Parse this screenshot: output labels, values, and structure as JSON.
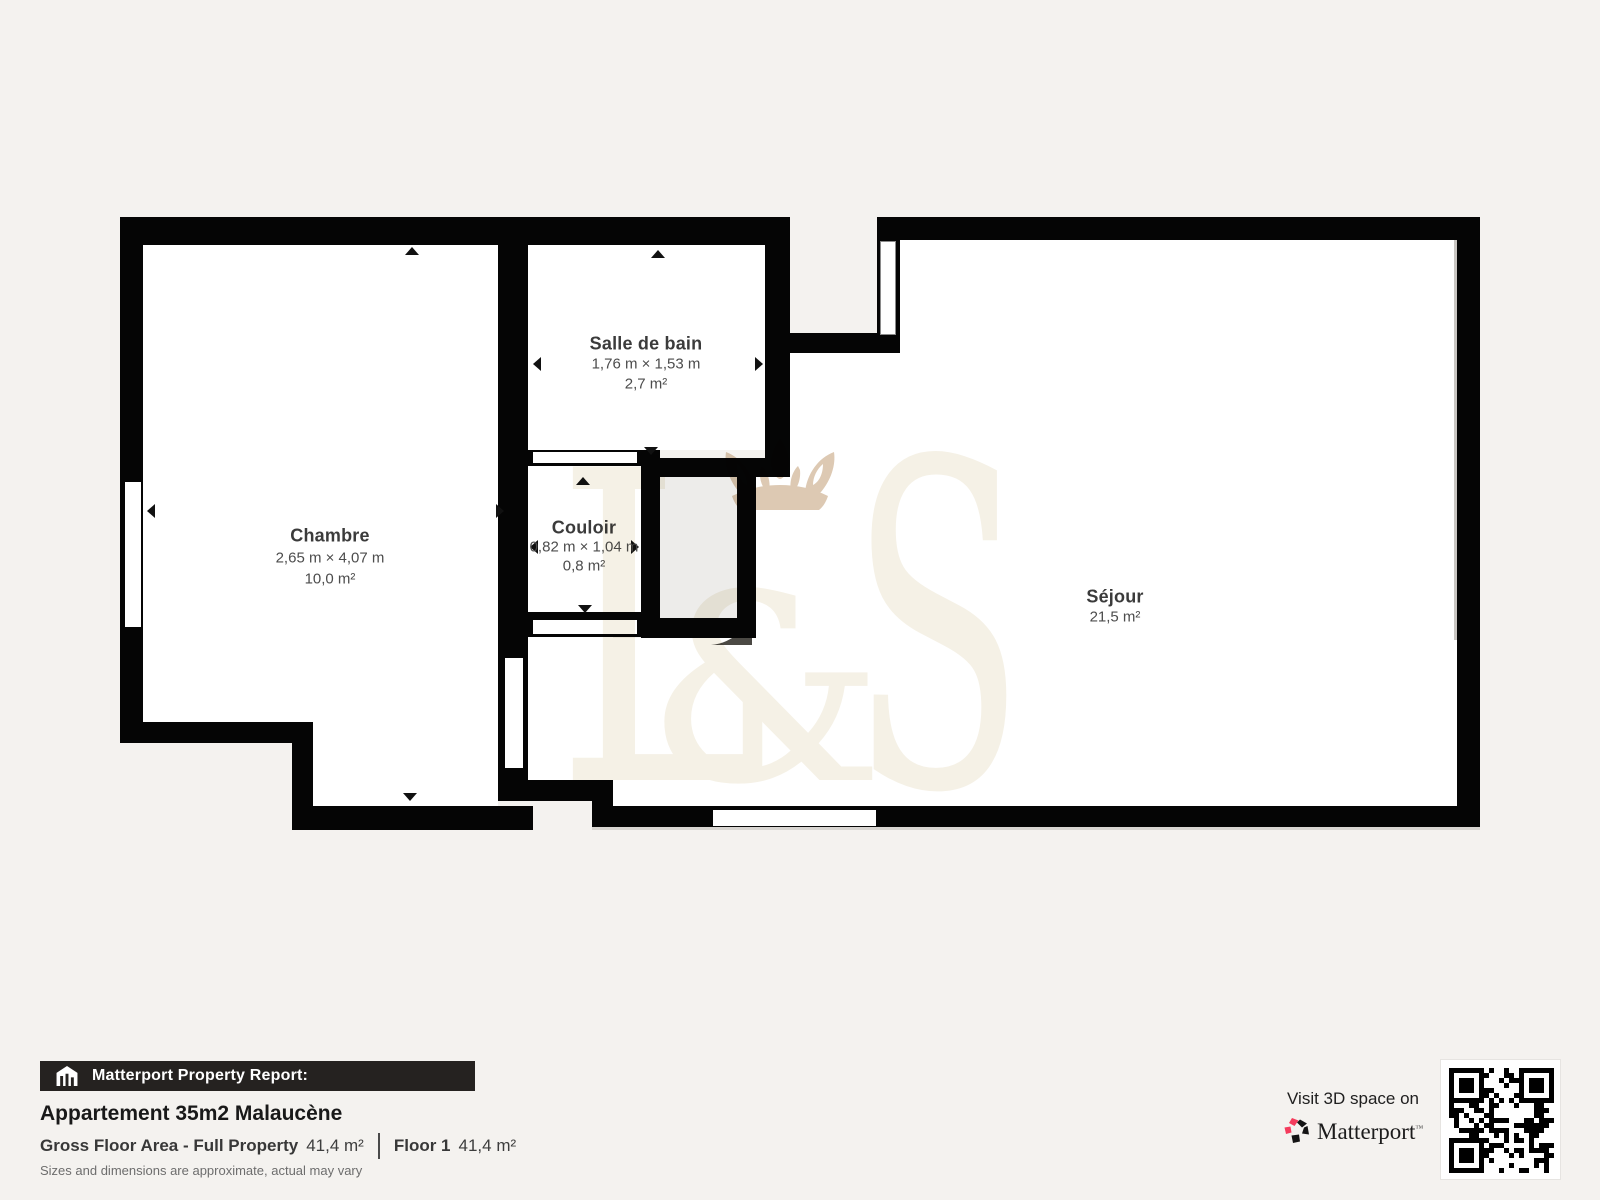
{
  "plan": {
    "rooms": [
      {
        "name": "Chambre",
        "dims": "2,65 m × 4,07 m",
        "area": "10,0 m²"
      },
      {
        "name": "Salle de bain",
        "dims": "1,76 m × 1,53 m",
        "area": "2,7 m²"
      },
      {
        "name": "Couloir",
        "dims": "0,82 m × 1,04 m",
        "area": "0,8 m²"
      },
      {
        "name": "Séjour",
        "area": "21,5 m²"
      }
    ],
    "watermark": {
      "l": "L",
      "amp": "&",
      "s": "S"
    }
  },
  "report": {
    "banner": "Matterport Property Report:",
    "title": "Appartement 35m2 Malaucène",
    "gross_label": "Gross Floor Area - Full Property",
    "gross_value": "41,4 m²",
    "floor_label": "Floor 1",
    "floor_value": "41,4 m²",
    "disclaimer": "Sizes and dimensions are approximate, actual may vary"
  },
  "cta": {
    "visit": "Visit 3D space on",
    "brand": "Matterport",
    "brand_mark": "™"
  },
  "colors": {
    "wall": "#050505",
    "room": "#ffffff",
    "accent_red": "#f43b5c",
    "crown_tan": "#ddc9b3",
    "monogram_cream": "#f5f1e6",
    "background": "#f4f2ef"
  }
}
